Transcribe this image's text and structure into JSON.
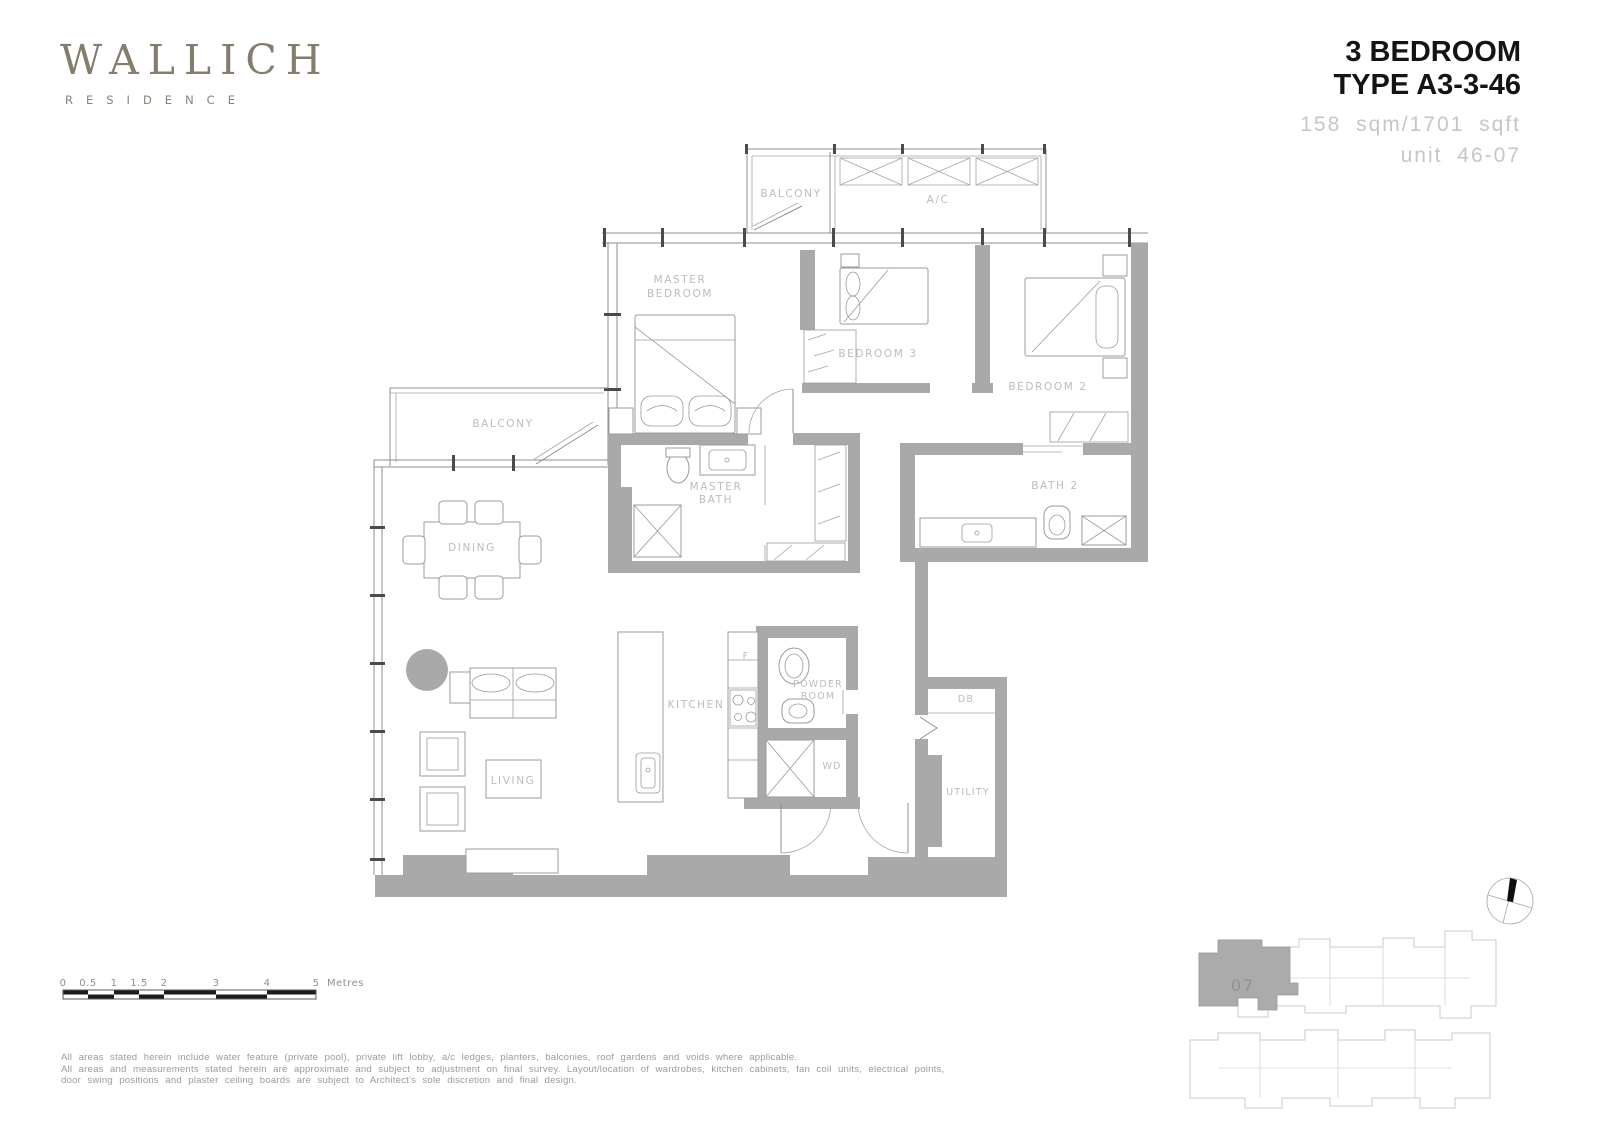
{
  "brand": {
    "name": "WALLICH",
    "sub": "RESIDENCE"
  },
  "title": {
    "line1": "3 BEDROOM",
    "line2": "TYPE A3-3-46",
    "area": "158 sqm/1701 sqft",
    "unit": "unit 46-07"
  },
  "plan": {
    "labels": {
      "balcony_top": "BALCONY",
      "ac": "A/C",
      "master_bedroom_1": "MASTER",
      "master_bedroom_2": "BEDROOM",
      "bedroom3": "BEDROOM 3",
      "bedroom2": "BEDROOM 2",
      "balcony_left": "BALCONY",
      "dining": "DINING",
      "master_bath_1": "MASTER",
      "master_bath_2": "BATH",
      "bath2": "BATH 2",
      "kitchen": "KITCHEN",
      "fridge": "F",
      "powder_1": "POWDER",
      "powder_2": "ROOM",
      "wd": "WD",
      "db": "DB",
      "utility": "UTILITY",
      "living": "LIVING"
    }
  },
  "scale_bar": {
    "ticks": [
      "0",
      "0.5",
      "1",
      "1.5",
      "2",
      "3",
      "4",
      "5"
    ],
    "unit": "Metres"
  },
  "key_plan": {
    "unit": "07"
  },
  "disclaimer": {
    "line1": "All areas stated herein include water feature (private pool), private lift lobby, a/c ledges, planters, balconies, roof gardens and voids where applicable.",
    "line2": "All areas and measurements stated herein are approximate and subject to adjustment on final survey. Layout/location of wardrobes, kitchen cabinets, fan coil units, electrical points,",
    "line3": "door swing positions and plaster ceiling boards are subject to Architect's sole discretion and final design."
  },
  "colors": {
    "brand": "#847c6d",
    "wall": "#a9a9a9",
    "label": "#bcbcbc"
  }
}
